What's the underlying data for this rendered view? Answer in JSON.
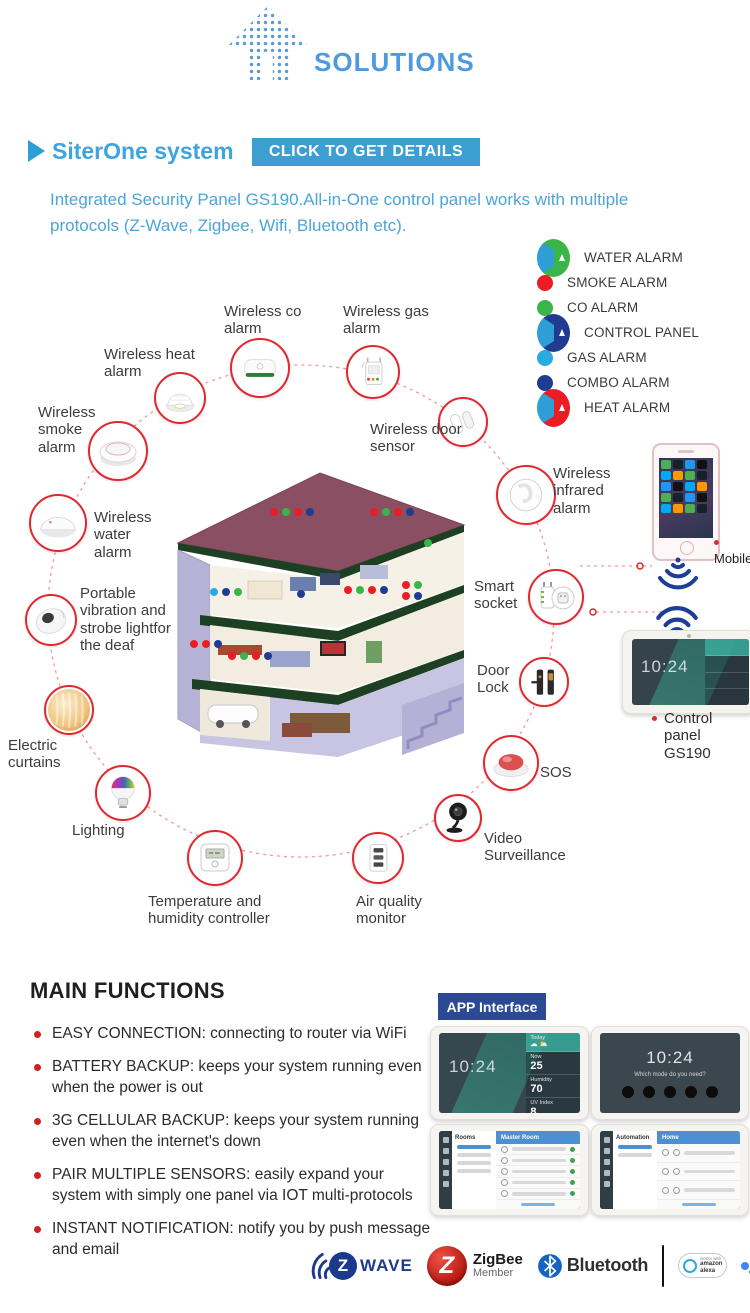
{
  "brand": {
    "name": "SOLUTIONS"
  },
  "hero": {
    "title": "SiterOne system",
    "cta": "CLICK TO GET DETAILS",
    "description_line1": "Integrated Security Panel GS190.All-in-One control panel works with multiple",
    "description_line2": "protocols (Z-Wave, Zigbee, Wifi, Bluetooth etc)."
  },
  "legend": {
    "items": [
      {
        "label": "WATER ALARM",
        "color": "#3AB54A",
        "marker": "triangle"
      },
      {
        "label": "SMOKE ALARM",
        "color": "#EC1C24",
        "marker": "dot"
      },
      {
        "label": "CO ALARM",
        "color": "#3AB54A",
        "marker": "dot"
      },
      {
        "label": "CONTROL PANEL",
        "color": "#1F3C92",
        "marker": "triangle"
      },
      {
        "label": "GAS ALARM",
        "color": "#29ABE2",
        "marker": "dot"
      },
      {
        "label": "COMBO ALARM",
        "color": "#1F3C92",
        "marker": "dot"
      },
      {
        "label": "HEAT ALARM",
        "color": "#EC1C24",
        "marker": "triangle"
      }
    ]
  },
  "diagram": {
    "devices": [
      {
        "label": "Wireless co alarm"
      },
      {
        "label": "Wireless gas alarm"
      },
      {
        "label": "Wireless heat alarm"
      },
      {
        "label": "Wireless smoke alarm"
      },
      {
        "label": "Wireless door sensor"
      },
      {
        "label": "Wireless infrared alarm"
      },
      {
        "label": "Smart socket"
      },
      {
        "label": "Door Lock"
      },
      {
        "label": "SOS"
      },
      {
        "label": "Video Surveillance"
      },
      {
        "label": "Air quality monitor"
      },
      {
        "label": "Temperature and humidity controller"
      },
      {
        "label": "Lighting"
      },
      {
        "label": "Electric curtains"
      },
      {
        "label": "Portable vibration and strobe lightfor the deaf"
      },
      {
        "label": "Wireless water alarm"
      }
    ],
    "mobile_label": "Mobile",
    "panel_label": "Control panel GS190",
    "panel_time": "10:24"
  },
  "main_functions": {
    "title": "MAIN FUNCTIONS",
    "bullets": [
      "EASY CONNECTION: connecting to router via WiFi",
      "BATTERY BACKUP: keeps your system running even when the power is out",
      "3G CELLULAR BACKUP: keeps your system running even when the internet's down",
      "PAIR MULTIPLE SENSORS: easily expand your system with simply one panel via IOT multi-protocols",
      "INSTANT NOTIFICATION: notify you by push message and email"
    ]
  },
  "app_interface": {
    "badge": "APP Interface",
    "dashboard": {
      "time": "10:24",
      "tiles": [
        {
          "title": "Today",
          "value": ""
        },
        {
          "title": "Now",
          "value": "25"
        },
        {
          "title": "Humidity",
          "value": "70"
        },
        {
          "title": "UV Index",
          "value": "8"
        }
      ]
    },
    "modes": {
      "time": "10:24",
      "prompt": "Which mode do you need?"
    },
    "rooms": {
      "menu": "Rooms",
      "header": "Master Room"
    },
    "automation": {
      "menu": "Automation",
      "header": "Home"
    }
  },
  "partners": {
    "zwave": {
      "letter": "Z",
      "text": "WAVE"
    },
    "zigbee": {
      "letter": "Z",
      "name": "ZigBee",
      "member": "Member"
    },
    "bluetooth": {
      "name": "Bluetooth"
    },
    "hue": {
      "top": "Friends of",
      "h": "h",
      "u": "u",
      "e": "e"
    },
    "alexa": {
      "top": "works with",
      "name": "amazon alexa"
    },
    "google": {
      "top": "works with the",
      "name": "Google Assistant"
    }
  }
}
